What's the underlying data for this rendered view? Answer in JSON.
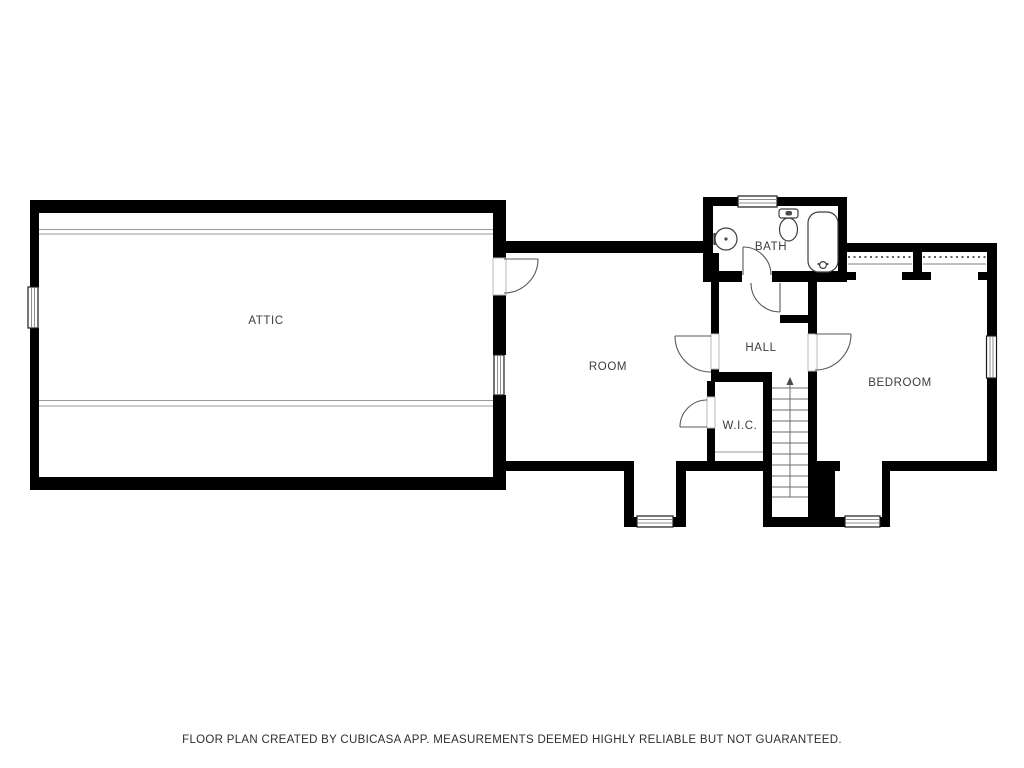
{
  "plan": {
    "creator_note": "Floor plan drawing (CubiCasa style), upper floor",
    "rooms": {
      "attic": "ATTIC",
      "room": "ROOM",
      "bath": "BATH",
      "hall": "HALL",
      "wic": "W.I.C.",
      "bedroom": "BEDROOM"
    },
    "fixtures": [
      "sink",
      "toilet",
      "bathtub",
      "stairs-up"
    ],
    "colors": {
      "wall": "#000000",
      "background": "#ffffff",
      "label_text": "#3c3c3c",
      "door_arc": "#5a5a5a",
      "thin_line": "#9a9a9a"
    }
  },
  "footer": {
    "disclaimer": "FLOOR PLAN CREATED BY CUBICASA APP. MEASUREMENTS DEEMED HIGHLY RELIABLE BUT NOT GUARANTEED."
  }
}
